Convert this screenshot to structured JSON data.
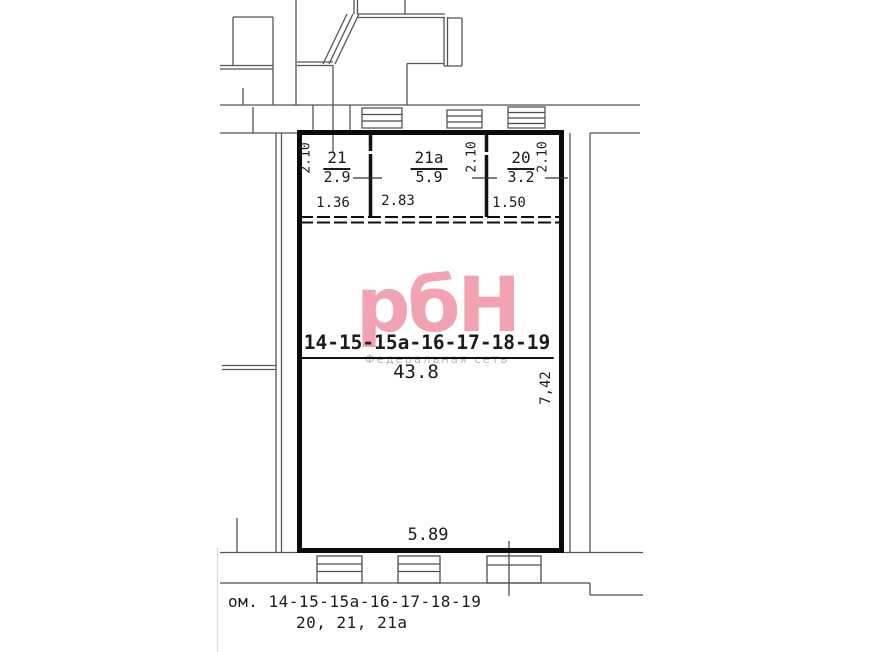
{
  "colors": {
    "wall": "#0b0b0b",
    "thin_line": "#555555",
    "watermark_pink": "#f2a3b1",
    "watermark_gray": "#b6b6b6"
  },
  "watermark": {
    "logo": "рбН",
    "subtitle": "Федеральная сеть"
  },
  "rooms": {
    "r21": {
      "id": "21",
      "area": "2.9",
      "width": "1.36",
      "height": "2.10"
    },
    "r21a": {
      "id": "21а",
      "area": "5.9",
      "width": "2.83",
      "height": "2.10"
    },
    "r20": {
      "id": "20",
      "area": "3.2",
      "width": "1.50",
      "height": "2.10"
    },
    "main": {
      "id": "14-15-15а-16-17-18-19",
      "area": "43.8",
      "width": "5.89",
      "height": "7,42"
    }
  },
  "footer": {
    "line1": "ом. 14-15-15а-16-17-18-19",
    "line2": "20, 21, 21а"
  }
}
